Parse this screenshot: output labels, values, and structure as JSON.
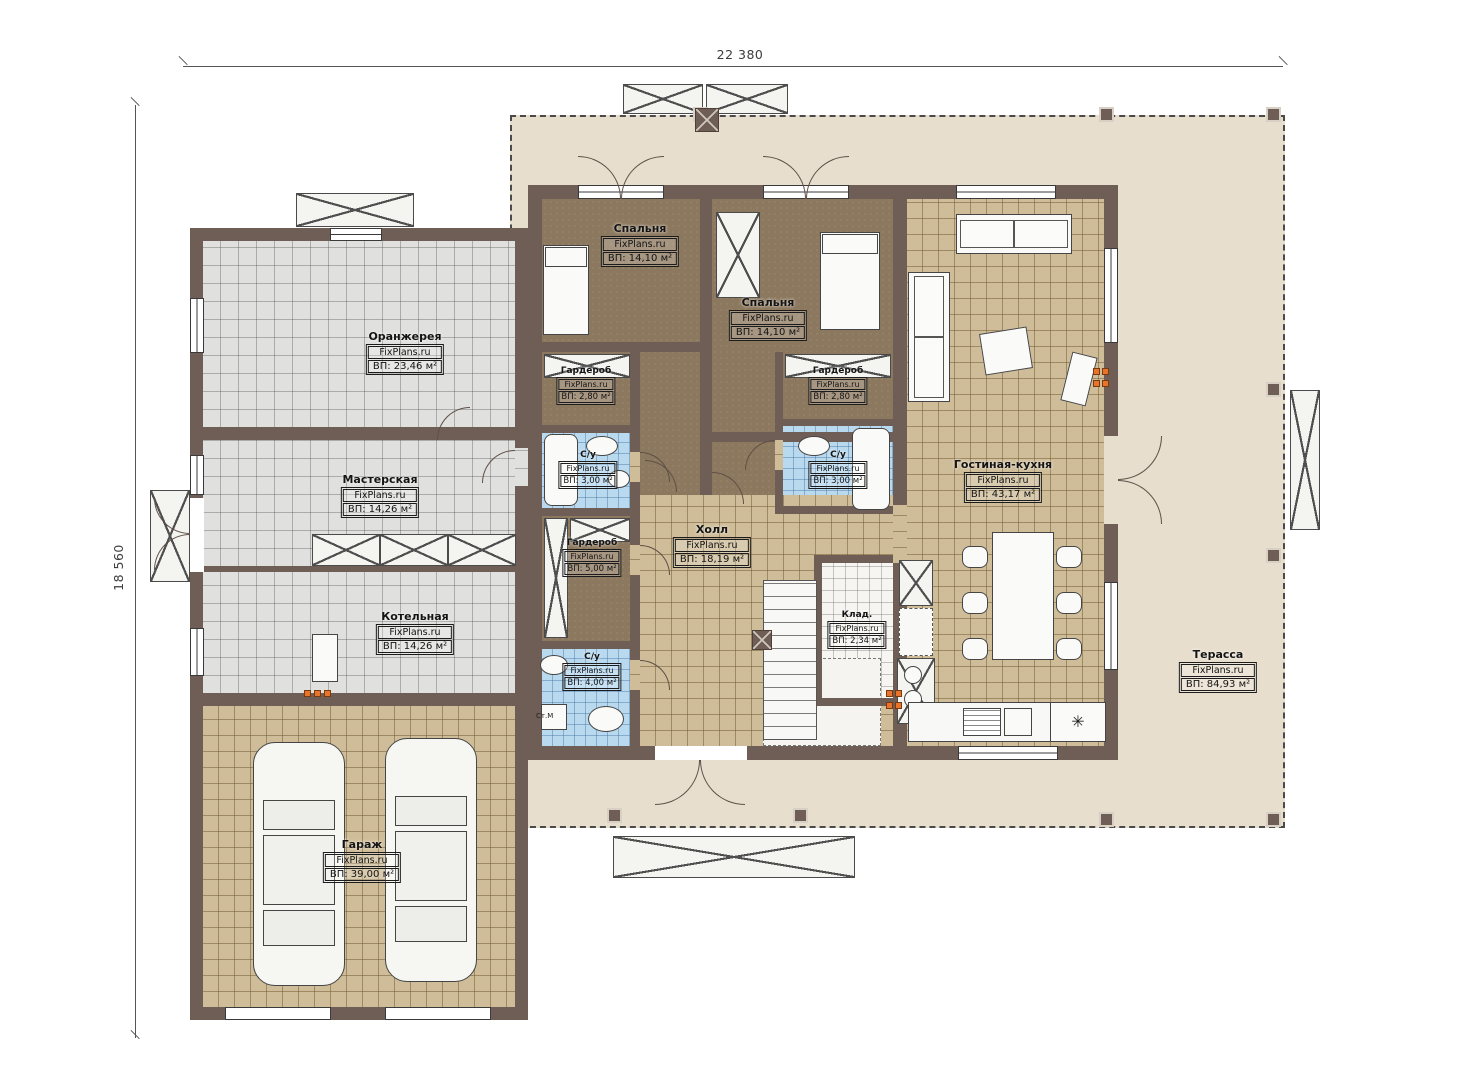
{
  "dimensions": {
    "width": "22 380",
    "height": "18 560"
  },
  "watermark": "FixPlans.ru",
  "rooms": [
    {
      "id": "orangery",
      "name": "Оранжерея",
      "area": "ВП: 23,46 м²"
    },
    {
      "id": "workshop",
      "name": "Мастерская",
      "area": "ВП: 14,26 м²"
    },
    {
      "id": "boiler-room",
      "name": "Котельная",
      "area": "ВП: 14,26 м²"
    },
    {
      "id": "garage",
      "name": "Гараж",
      "area": "ВП: 39,00 м²"
    },
    {
      "id": "bedroom-1",
      "name": "Спальня",
      "area": "ВП: 14,10 м²"
    },
    {
      "id": "bedroom-2",
      "name": "Спальня",
      "area": "ВП: 14,10 м²"
    },
    {
      "id": "wardrobe-1",
      "name": "Гардероб",
      "area": "ВП: 2,80 м²"
    },
    {
      "id": "bathroom-1",
      "name": "С/у",
      "area": "ВП: 3,00 м²"
    },
    {
      "id": "wardrobe-2",
      "name": "Гардероб",
      "area": "ВП: 2,80 м²"
    },
    {
      "id": "bathroom-2",
      "name": "С/у",
      "area": "ВП: 3,00 м²"
    },
    {
      "id": "wardrobe-3",
      "name": "Гардероб",
      "area": "ВП: 5,00 м²"
    },
    {
      "id": "bathroom-3",
      "name": "С/у",
      "area": "ВП: 4,00 м²"
    },
    {
      "id": "hall",
      "name": "Холл",
      "area": "ВП: 18,19 м²"
    },
    {
      "id": "storage",
      "name": "Клад.",
      "area": "ВП: 2,34 м²"
    },
    {
      "id": "living-kitchen",
      "name": "Гостиная-кухня",
      "area": "ВП: 43,17 м²"
    },
    {
      "id": "terrace",
      "name": "Терасса",
      "area": "ВП: 84,93 м²"
    }
  ],
  "annotations": {
    "washing_machine": "Ст.М"
  },
  "icons": {
    "fridge": "✳"
  },
  "colors": {
    "wall": "#6F5E56",
    "terrace_floor": "#E8DECD",
    "tile_tan": "#CFBD99",
    "tile_gray": "#E0E0DE",
    "tile_blue": "#B9D9EF",
    "bedroom_floor": "#8C785E",
    "accent_orange": "#E8732A"
  }
}
